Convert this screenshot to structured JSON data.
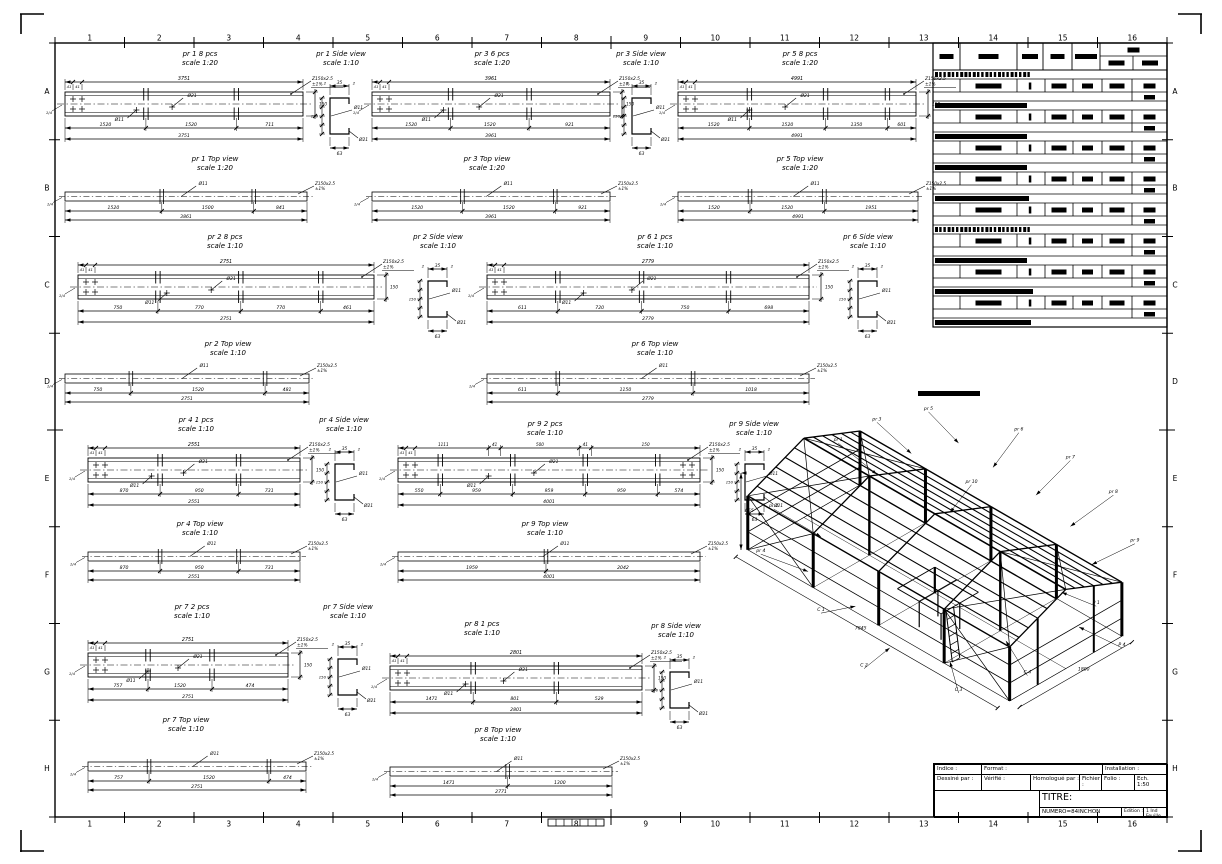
{
  "border": {
    "cols": [
      "1",
      "2",
      "3",
      "4",
      "5",
      "6",
      "7",
      "8",
      "9",
      "10",
      "11",
      "12",
      "13",
      "14",
      "15",
      "16"
    ],
    "rows": [
      "A",
      "B",
      "C",
      "D",
      "E",
      "F",
      "G",
      "H"
    ]
  },
  "defaults": {
    "note": "Z150x2.5",
    "note2": "±1%",
    "hole_big": "Ø21",
    "hole_small": "Ø11",
    "beam_h": "150",
    "weld": "1/4",
    "side_end": "2",
    "mini": "41"
  },
  "views": [
    {
      "id": "pr1-elev",
      "type": "beam",
      "title": "pr 1  8 pcs",
      "scale": "scale 1:20",
      "x": 65,
      "y": 72,
      "w": 238,
      "lx": 200,
      "ly": 50,
      "spl": [
        0.34,
        0.72
      ],
      "dims": {
        "top": "3751",
        "segs": [
          "1520",
          "1520",
          "711"
        ],
        "total": "3751"
      }
    },
    {
      "id": "pr1-side",
      "type": "side",
      "title": "pr 1  Side view",
      "scale": "scale 1:10",
      "x": 310,
      "y": 72,
      "lx": 341,
      "ly": 50,
      "dims": {
        "top": "35",
        "bottom": "63"
      }
    },
    {
      "id": "pr3-elev",
      "type": "beam",
      "title": "pr 3  6 pcs",
      "scale": "scale 1:20",
      "x": 372,
      "y": 72,
      "w": 238,
      "lx": 492,
      "ly": 50,
      "spl": [
        0.33,
        0.66
      ],
      "dims": {
        "top": "3961",
        "segs": [
          "1520",
          "1520",
          "921"
        ],
        "total": "3961"
      }
    },
    {
      "id": "pr3-side",
      "type": "side",
      "title": "pr 3  Side view",
      "scale": "scale 1:10",
      "x": 612,
      "y": 72,
      "lx": 641,
      "ly": 50,
      "dims": {
        "top": "35",
        "bottom": "63"
      }
    },
    {
      "id": "pr5-elev",
      "type": "beam",
      "title": "pr 5  8 pcs",
      "scale": "scale 1:20",
      "x": 678,
      "y": 72,
      "w": 238,
      "lx": 800,
      "ly": 50,
      "spl": [
        0.3,
        0.62,
        0.88
      ],
      "dims": {
        "top": "4991",
        "segs": [
          "1520",
          "1520",
          "1350",
          "601"
        ],
        "total": "4991"
      }
    },
    {
      "id": "pr1-top",
      "type": "top",
      "title": "pr 1  Top view",
      "scale": "scale 1:20",
      "x": 65,
      "y": 180,
      "w": 242,
      "lx": 215,
      "ly": 155,
      "spl": [
        0.4,
        0.78
      ],
      "dims": {
        "segs": [
          "1520",
          "1500",
          "841"
        ],
        "total": "3861"
      }
    },
    {
      "id": "pr3-top",
      "type": "top",
      "title": "pr 3  Top view",
      "scale": "scale 1:20",
      "x": 372,
      "y": 180,
      "w": 238,
      "lx": 487,
      "ly": 155,
      "spl": [
        0.38,
        0.77
      ],
      "dims": {
        "segs": [
          "1520",
          "1520",
          "921"
        ],
        "total": "3961"
      }
    },
    {
      "id": "pr5-top",
      "type": "top",
      "title": "pr 5  Top view",
      "scale": "scale 1:20",
      "x": 678,
      "y": 180,
      "w": 240,
      "lx": 800,
      "ly": 155,
      "spl": [
        0.3,
        0.61
      ],
      "dims": {
        "segs": [
          "1520",
          "1520",
          "1951"
        ],
        "total": "4991"
      }
    },
    {
      "id": "pr2-elev",
      "type": "beam",
      "title": "pr 2  8 pcs",
      "scale": "scale 1:10",
      "x": 78,
      "y": 255,
      "w": 296,
      "lx": 225,
      "ly": 233,
      "spl": [
        0.27,
        0.55,
        0.82
      ],
      "dims": {
        "top": "2751",
        "segs": [
          "750",
          "770",
          "770",
          "461"
        ],
        "total": "2751"
      }
    },
    {
      "id": "pr2-side",
      "type": "side",
      "title": "pr 2  Side view",
      "scale": "scale 1:10",
      "x": 408,
      "y": 255,
      "lx": 438,
      "ly": 233,
      "dims": {
        "top": "35",
        "bottom": "63"
      }
    },
    {
      "id": "pr6-elev",
      "type": "beam",
      "title": "pr 6  1 pcs",
      "scale": "scale 1:10",
      "x": 487,
      "y": 255,
      "w": 322,
      "lx": 655,
      "ly": 233,
      "spl": [
        0.22,
        0.48,
        0.75
      ],
      "dims": {
        "top": "2779",
        "segs": [
          "611",
          "720",
          "750",
          "698"
        ],
        "total": "2779"
      }
    },
    {
      "id": "pr6-side",
      "type": "side",
      "title": "pr 6  Side view",
      "scale": "scale 1:10",
      "x": 838,
      "y": 255,
      "lx": 868,
      "ly": 233,
      "dims": {
        "top": "35",
        "bottom": "63"
      }
    },
    {
      "id": "pr2-top",
      "type": "top",
      "title": "pr 2  Top view",
      "scale": "scale 1:10",
      "x": 65,
      "y": 362,
      "w": 244,
      "lx": 228,
      "ly": 340,
      "spl": [
        0.27,
        0.82
      ],
      "dims": {
        "segs": [
          "750",
          "1520",
          "481"
        ],
        "total": "2751"
      }
    },
    {
      "id": "pr6-top",
      "type": "top",
      "title": "pr 6  Top view",
      "scale": "scale 1:10",
      "x": 487,
      "y": 362,
      "w": 322,
      "lx": 655,
      "ly": 340,
      "spl": [
        0.22,
        0.64
      ],
      "dims": {
        "segs": [
          "611",
          "1150",
          "1018"
        ],
        "total": "2779"
      }
    },
    {
      "id": "pr4-elev",
      "type": "beam",
      "title": "pr 4  1 pcs",
      "scale": "scale 1:10",
      "x": 88,
      "y": 438,
      "w": 212,
      "lx": 196,
      "ly": 416,
      "spl": [
        0.34,
        0.71
      ],
      "dims": {
        "top": "2551",
        "segs": [
          "870",
          "950",
          "731"
        ],
        "total": "2551"
      }
    },
    {
      "id": "pr4-side",
      "type": "side",
      "title": "pr 4  Side view",
      "scale": "scale 1:10",
      "x": 315,
      "y": 438,
      "lx": 344,
      "ly": 416,
      "dims": {
        "top": "35",
        "bottom": "63"
      }
    },
    {
      "id": "pr9-elev",
      "type": "beam",
      "title": "pr 9  2 pcs",
      "scale": "scale 1:10",
      "x": 398,
      "y": 438,
      "w": 302,
      "lx": 545,
      "ly": 420,
      "spl": [
        0.14,
        0.38,
        0.62,
        0.86
      ],
      "holes_right": true,
      "dims": {
        "top_segs": [
          "1111",
          "41",
          "500",
          "41",
          "150"
        ],
        "top_ticks": [
          0.3,
          0.34,
          0.6,
          0.64
        ],
        "segs": [
          "550",
          "959",
          "959",
          "959",
          "574"
        ],
        "total": "4001"
      }
    },
    {
      "id": "pr9-side",
      "type": "side",
      "title": "pr 9  Side view",
      "scale": "scale 1:10",
      "x": 725,
      "y": 438,
      "lx": 754,
      "ly": 420,
      "dims": {
        "top": "35",
        "bottom": "63"
      }
    },
    {
      "id": "pr4-top",
      "type": "top",
      "title": "pr 4  Top view",
      "scale": "scale 1:10",
      "x": 88,
      "y": 540,
      "w": 212,
      "lx": 200,
      "ly": 520,
      "spl": [
        0.34,
        0.71
      ],
      "dims": {
        "segs": [
          "870",
          "950",
          "731"
        ],
        "total": "2551"
      }
    },
    {
      "id": "pr9-top",
      "type": "top",
      "title": "pr 9  Top view",
      "scale": "scale 1:10",
      "x": 398,
      "y": 540,
      "w": 302,
      "lx": 545,
      "ly": 520,
      "spl": [
        0.49
      ],
      "dims": {
        "segs": [
          "1959",
          "2042"
        ],
        "total": "4001"
      }
    },
    {
      "id": "pr7-elev",
      "type": "beam",
      "title": "pr 7  2 pcs",
      "scale": "scale 1:10",
      "x": 88,
      "y": 633,
      "w": 200,
      "lx": 192,
      "ly": 603,
      "spl": [
        0.3,
        0.62
      ],
      "dims": {
        "top": "2751",
        "segs": [
          "757",
          "1520",
          "474"
        ],
        "total": "2751"
      }
    },
    {
      "id": "pr7-side",
      "type": "side",
      "title": "pr 7  Side view",
      "scale": "scale 1:10",
      "x": 318,
      "y": 633,
      "lx": 348,
      "ly": 603,
      "dims": {
        "top": "35",
        "bottom": "63"
      }
    },
    {
      "id": "pr8-elev",
      "type": "beam",
      "title": "pr 8  1 pcs",
      "scale": "scale 1:10",
      "x": 390,
      "y": 646,
      "w": 252,
      "lx": 482,
      "ly": 620,
      "spl": [
        0.33,
        0.66
      ],
      "dims": {
        "top": "2801",
        "segs": [
          "1471",
          "801",
          "529"
        ],
        "total": "2801"
      }
    },
    {
      "id": "pr8-side",
      "type": "side",
      "title": "pr 8  Side view",
      "scale": "scale 1:10",
      "x": 650,
      "y": 646,
      "lx": 676,
      "ly": 622,
      "dims": {
        "top": "35",
        "bottom": "63"
      }
    },
    {
      "id": "pr7-top",
      "type": "top",
      "title": "pr 7  Top view",
      "scale": "scale 1:10",
      "x": 88,
      "y": 750,
      "w": 218,
      "lx": 186,
      "ly": 716,
      "spl": [
        0.28,
        0.83
      ],
      "dims": {
        "segs": [
          "757",
          "1520",
          "474"
        ],
        "total": "2751"
      }
    },
    {
      "id": "pr8-top",
      "type": "top",
      "title": "pr 8  Top view",
      "scale": "scale 1:10",
      "x": 390,
      "y": 755,
      "w": 222,
      "lx": 498,
      "ly": 726,
      "spl": [
        0.53
      ],
      "dims": {
        "segs": [
          "1471",
          "1300"
        ],
        "total": "2771"
      }
    }
  ],
  "table": {
    "x": 933,
    "y": 43,
    "w": 234,
    "cols": [
      0,
      27,
      84,
      110,
      139,
      167,
      234
    ],
    "data_cols": [
      0,
      27,
      84,
      112,
      140,
      169,
      199,
      234
    ],
    "header_h": 27,
    "group_h": 31,
    "groups": [
      {
        "style": "striped",
        "hdr_w": 96
      },
      {
        "style": "solid",
        "hdr_w": 92
      },
      {
        "style": "solid",
        "hdr_w": 92
      },
      {
        "style": "solid",
        "hdr_w": 92
      },
      {
        "style": "solid",
        "hdr_w": 94
      },
      {
        "style": "striped",
        "hdr_w": 96
      },
      {
        "style": "solid",
        "hdr_w": 92
      },
      {
        "style": "solid",
        "hdr_w": 98
      }
    ],
    "trailing_hdr_w": 96
  },
  "title_block": {
    "indice": "Indice :",
    "format": "Format :",
    "installation": "Installation :",
    "dessine": "Dessiné par :",
    "verifie": "Vérifié :",
    "homologue": "Homologué par :",
    "fichier": "Fichier :",
    "folio": "Folio :",
    "ech1": "Ech.",
    "ech2": "1:50",
    "titre": "TITRE:",
    "numero": "NUMERO=84INCHON",
    "edition": "Edition :",
    "feuille1": "1 Ind",
    "feuille2": "Feuille"
  },
  "iso": {
    "callouts": [
      {
        "t": "pr 1",
        "tx": 0.24,
        "ty": 0.13,
        "ax": 0.33,
        "ay": 0.22
      },
      {
        "t": "pr 3",
        "tx": 0.33,
        "ty": 0.07,
        "ax": 0.41,
        "ay": 0.16
      },
      {
        "t": "pr 5",
        "tx": 0.45,
        "ty": 0.04,
        "ax": 0.52,
        "ay": 0.13
      },
      {
        "t": "pr 2",
        "tx": 0.09,
        "ty": 0.32,
        "ax": 0.2,
        "ay": 0.4
      },
      {
        "t": "pr 4",
        "tx": 0.06,
        "ty": 0.45,
        "ax": 0.17,
        "ay": 0.5
      },
      {
        "t": "pr 6",
        "tx": 0.66,
        "ty": 0.1,
        "ax": 0.6,
        "ay": 0.2
      },
      {
        "t": "pr 7",
        "tx": 0.78,
        "ty": 0.18,
        "ax": 0.7,
        "ay": 0.28
      },
      {
        "t": "pr 8",
        "tx": 0.88,
        "ty": 0.28,
        "ax": 0.78,
        "ay": 0.37
      },
      {
        "t": "pr 9",
        "tx": 0.93,
        "ty": 0.42,
        "ax": 0.83,
        "ay": 0.48
      },
      {
        "t": "pr 10",
        "tx": 0.55,
        "ty": 0.25,
        "ax": 0.5,
        "ay": 0.33
      },
      {
        "t": "C 1",
        "tx": 0.2,
        "ty": 0.62,
        "ax": 0.28,
        "ay": 0.6
      },
      {
        "t": "C 2",
        "tx": 0.3,
        "ty": 0.78,
        "ax": 0.36,
        "ay": 0.72
      },
      {
        "t": "C 3",
        "tx": 0.52,
        "ty": 0.85,
        "ax": 0.5,
        "ay": 0.76
      },
      {
        "t": "C 4",
        "tx": 0.68,
        "ty": 0.8,
        "ax": 0.63,
        "ay": 0.7
      },
      {
        "t": "P 1",
        "tx": 0.84,
        "ty": 0.6,
        "ax": 0.76,
        "ay": 0.56
      },
      {
        "t": "P 4",
        "tx": 0.9,
        "ty": 0.72,
        "ax": 0.8,
        "ay": 0.66
      }
    ],
    "dims": {
      "front": "7845",
      "side": "1800",
      "height": "655"
    }
  }
}
